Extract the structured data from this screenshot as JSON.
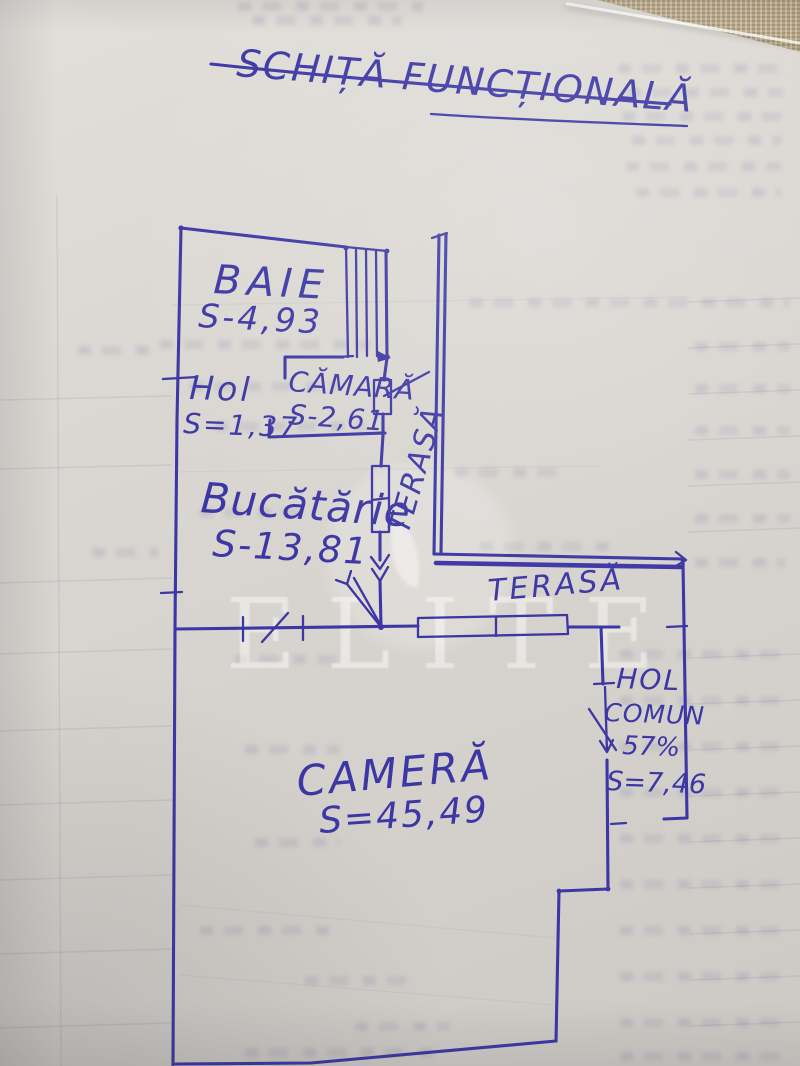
{
  "title": "SCHIȚĂ FUNCȚIONALĂ",
  "watermark": "ELITE",
  "colors": {
    "ink": "#3c37a4",
    "paper": "#d8d5d0"
  },
  "rooms": {
    "baie": {
      "name": "BAIE",
      "area": "S-4,93"
    },
    "hol": {
      "name": "Hol",
      "area": "S=1,37"
    },
    "camara": {
      "name": "CĂMARĂ",
      "area": "S-2,61"
    },
    "bucatarie": {
      "name": "Bucătărie",
      "area": "S-13,81"
    },
    "camera": {
      "name": "CAMERĂ",
      "area": "S=45,49"
    },
    "hol_comun": {
      "name": "HOL",
      "name2": "COMUN",
      "share": "57%",
      "area": "S=7,46"
    },
    "terasa_side": {
      "name": "TERASĂ"
    },
    "terasa_front": {
      "name": "TERASĂ"
    }
  }
}
